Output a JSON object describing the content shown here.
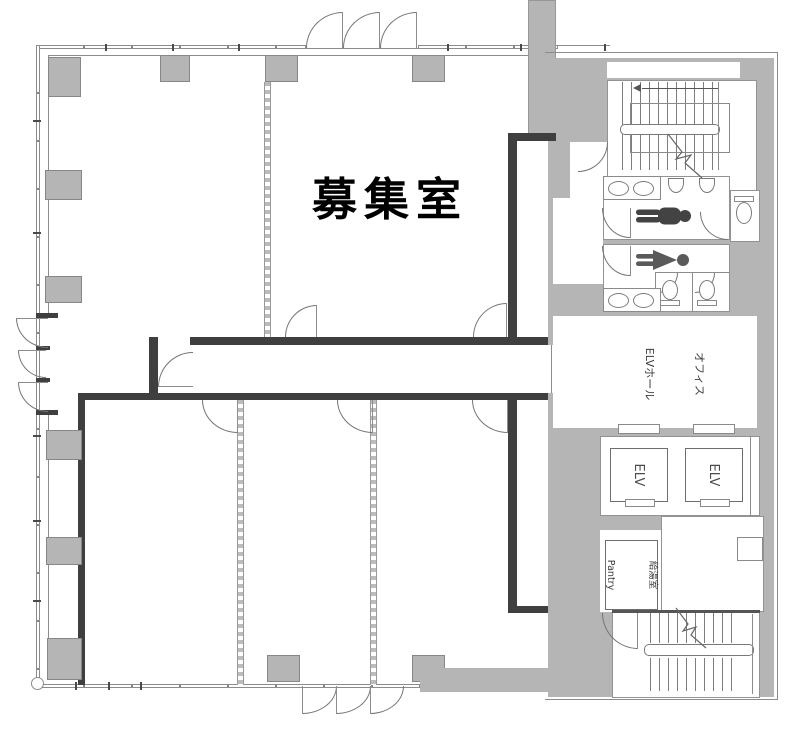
{
  "plan": {
    "type": "building-floor-plan",
    "labels": {
      "main_room": "募集室",
      "hall_line1": "オフィス",
      "hall_line2": "ELVホール",
      "pantry_line1": "給湯室",
      "pantry_line2": "Pantry"
    },
    "elevators": [
      {
        "label": "ELV"
      },
      {
        "label": "ELV"
      }
    ],
    "icons": [
      "male-figure-icon",
      "female-figure-icon",
      "stair-direction-arrow",
      "door-arc",
      "stair-break-line"
    ],
    "colors": {
      "wall_gray": "#b5b5b5",
      "tenant_wall_dark": "#3f3f3f",
      "outline": "#8c8c8c",
      "male_figure": "#434343",
      "female_figure": "#5a5a5a",
      "text": "#000000"
    }
  }
}
